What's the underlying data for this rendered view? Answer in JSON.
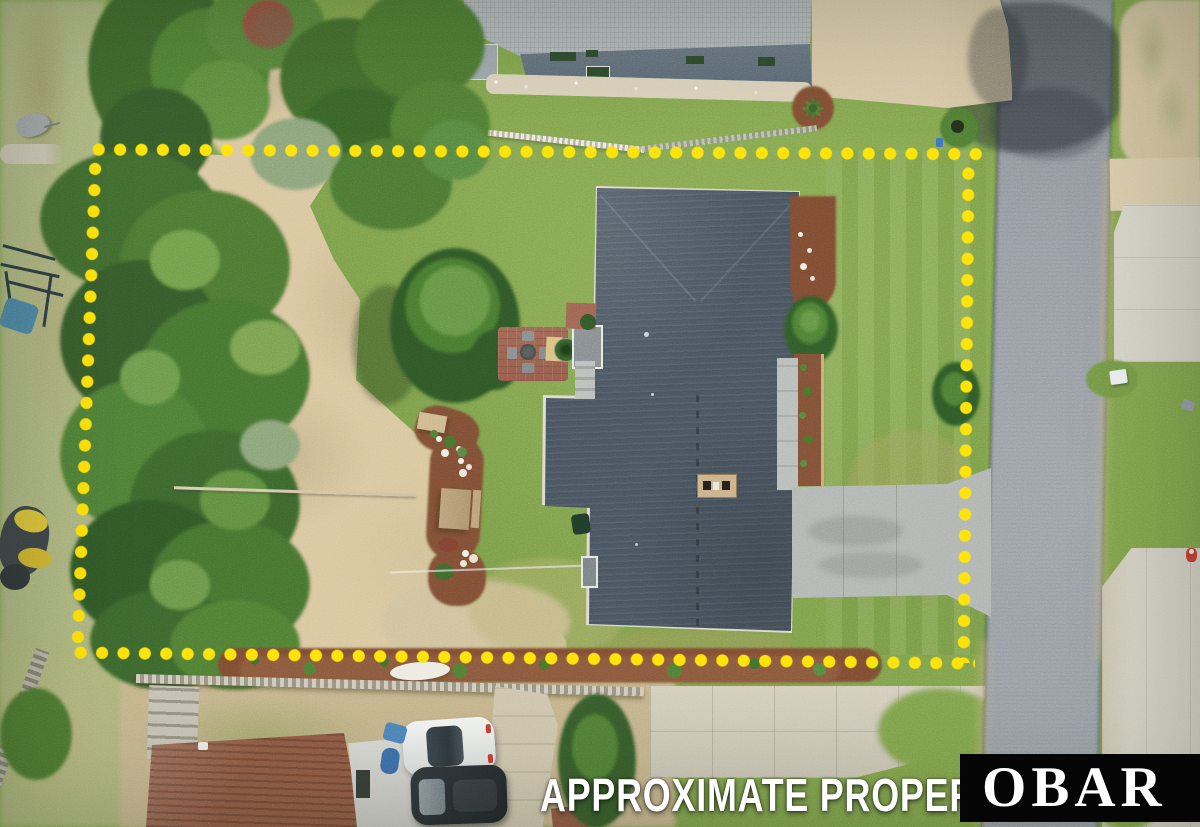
{
  "overlay": {
    "watermark_text": "APPROXIMATE PROPERTY LIN",
    "logo_text": "OBAR",
    "colors": {
      "property_dots": "#FFE10A",
      "watermark_text": "#FFFFFF",
      "logo_background": "#050505",
      "logo_text": "#FFFFFF"
    }
  },
  "scene_palette": {
    "grass": "#7B9F4A",
    "sand": "#D8C59C",
    "road_asphalt": "#939AA1",
    "concrete": "#D5D2C6",
    "main_roof": "#47525D",
    "neighbor_roof_top": "#ADB3B6",
    "neighbor_roof_bottom": "#8A5742",
    "mulch": "#7A4A31",
    "vegetation_dark": "#3E662C"
  }
}
